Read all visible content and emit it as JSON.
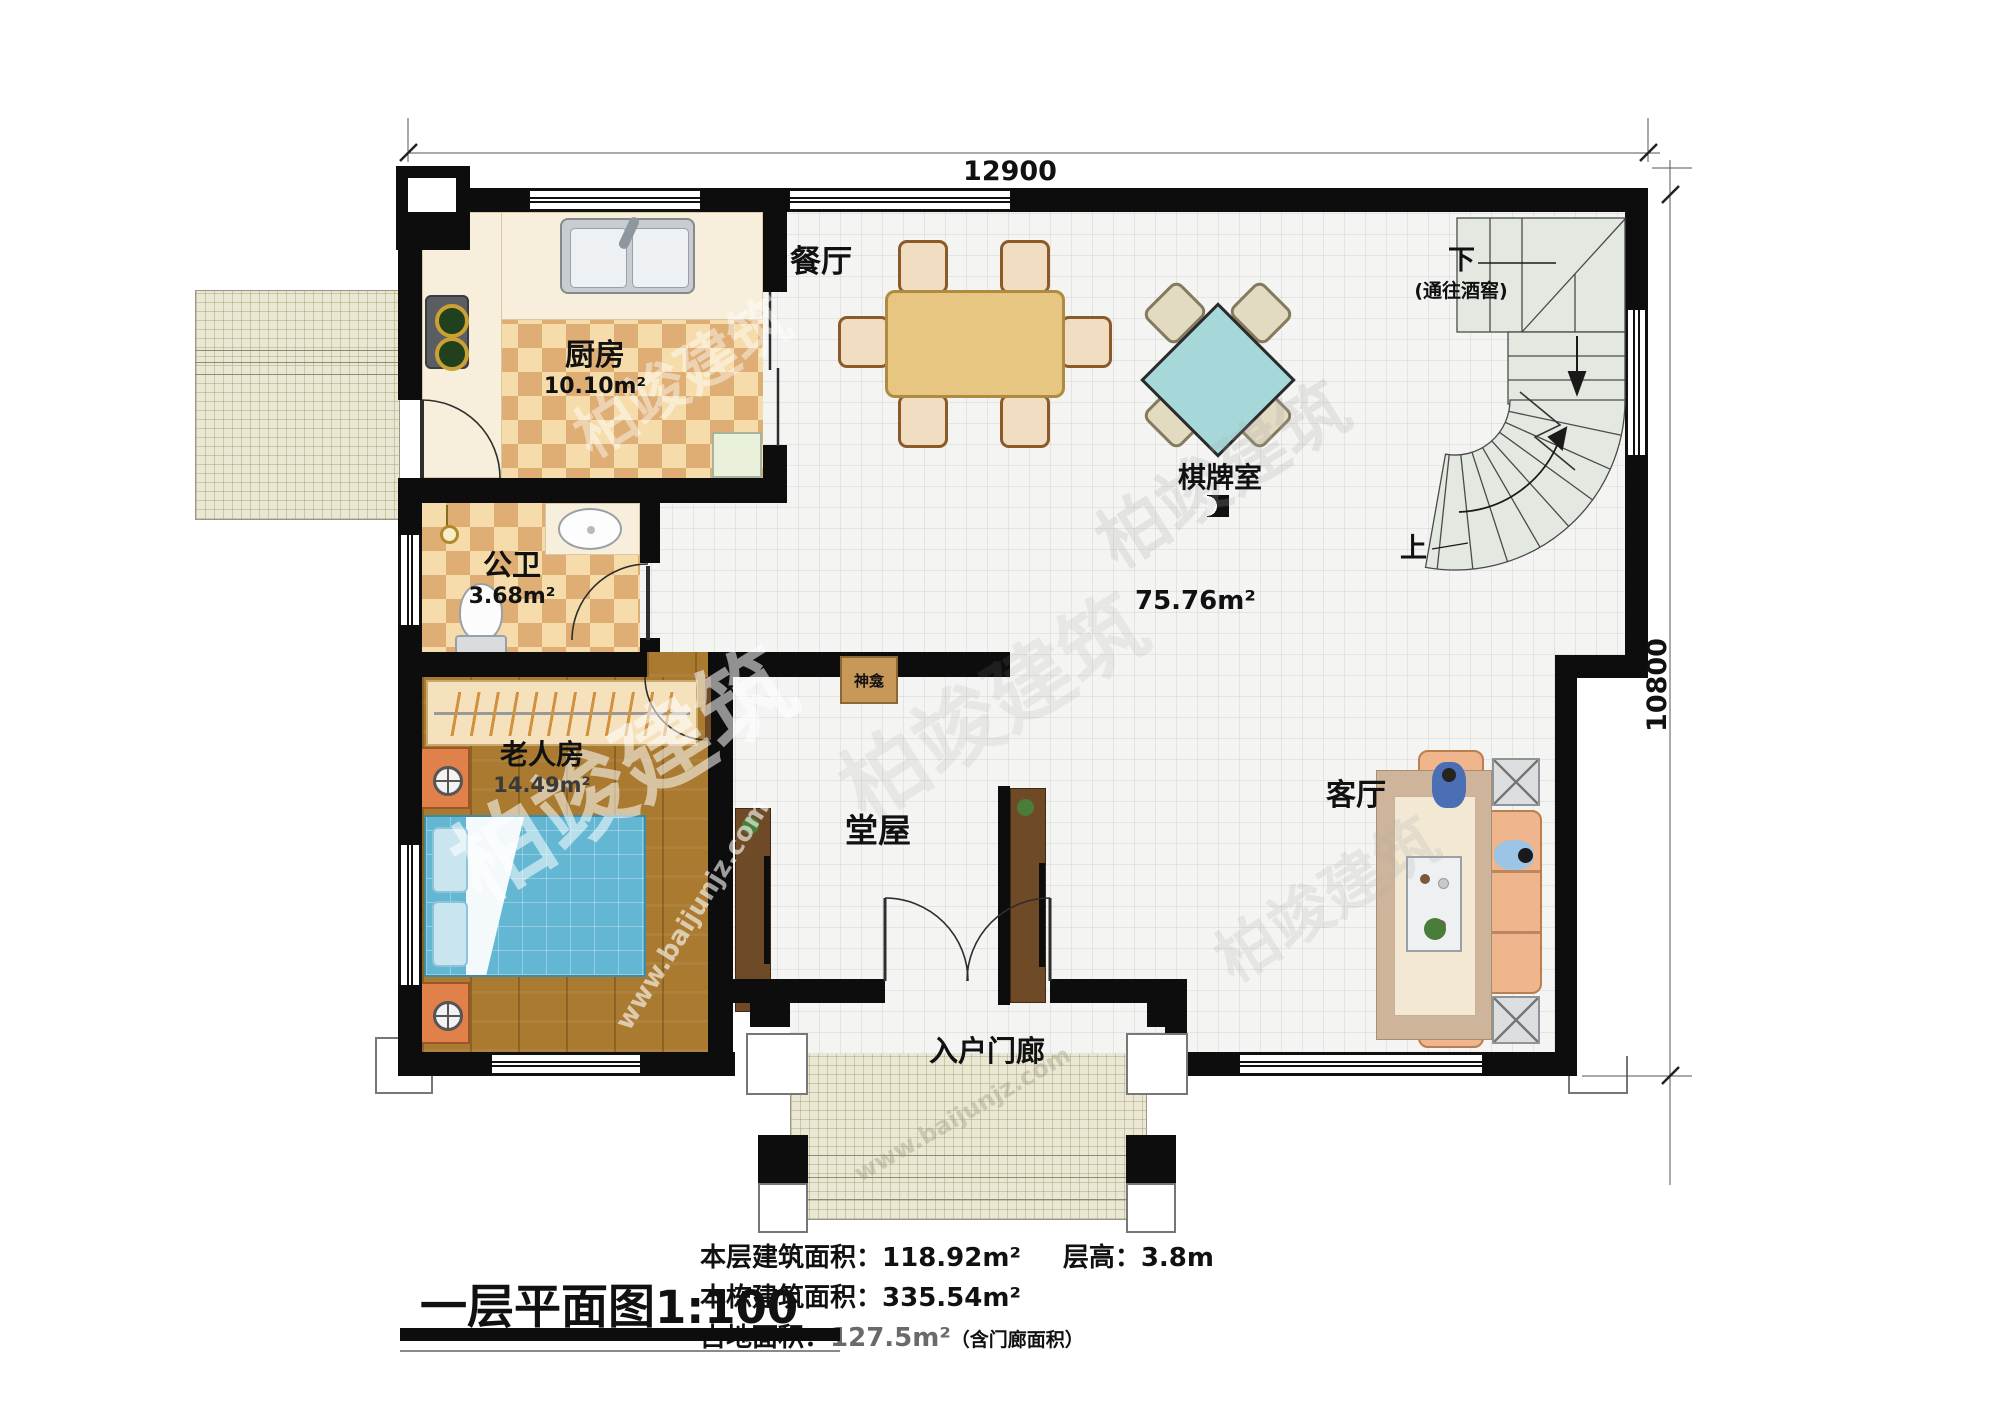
{
  "title": {
    "text": "一层平面图",
    "scale": "1:100"
  },
  "dimensions": {
    "width": "12900",
    "height": "10800"
  },
  "rooms": {
    "dining": {
      "label": "餐厅"
    },
    "kitchen": {
      "label": "厨房",
      "area": "10.10m²"
    },
    "bath": {
      "label": "公卫",
      "area": "3.68m²"
    },
    "elder": {
      "label": "老人房",
      "area": "14.49m²"
    },
    "chess": {
      "label": "棋牌室"
    },
    "hall": {
      "label": "堂屋"
    },
    "living": {
      "label": "客厅"
    },
    "porch": {
      "label": "入户门廊"
    },
    "open": {
      "area": "75.76m²"
    },
    "shrine": {
      "label": "神龛"
    }
  },
  "stairs": {
    "down": "下",
    "down_note": "(通往酒窖)",
    "up": "上"
  },
  "stats": {
    "floor_area_label": "本层建筑面积：",
    "floor_area_value": "118.92m²",
    "storey_height_label": "层高：",
    "storey_height_value": "3.8m",
    "total_area_label": "本栋建筑面积：",
    "total_area_value": "335.54m²",
    "footprint_label": "占地面积：",
    "footprint_value": "127.5m²",
    "footprint_note": "（含门廊面积）"
  },
  "watermark": {
    "brand": "柏竣建筑",
    "site": "www.baijunjz.com"
  },
  "colors": {
    "wall": "#0d0d0d",
    "stair_fill": "#e3e9e1",
    "chess_table": "#a6d8da",
    "wood_floor": "#a97a30",
    "sofa": "#efb58c",
    "bed": "#63b7d2"
  }
}
